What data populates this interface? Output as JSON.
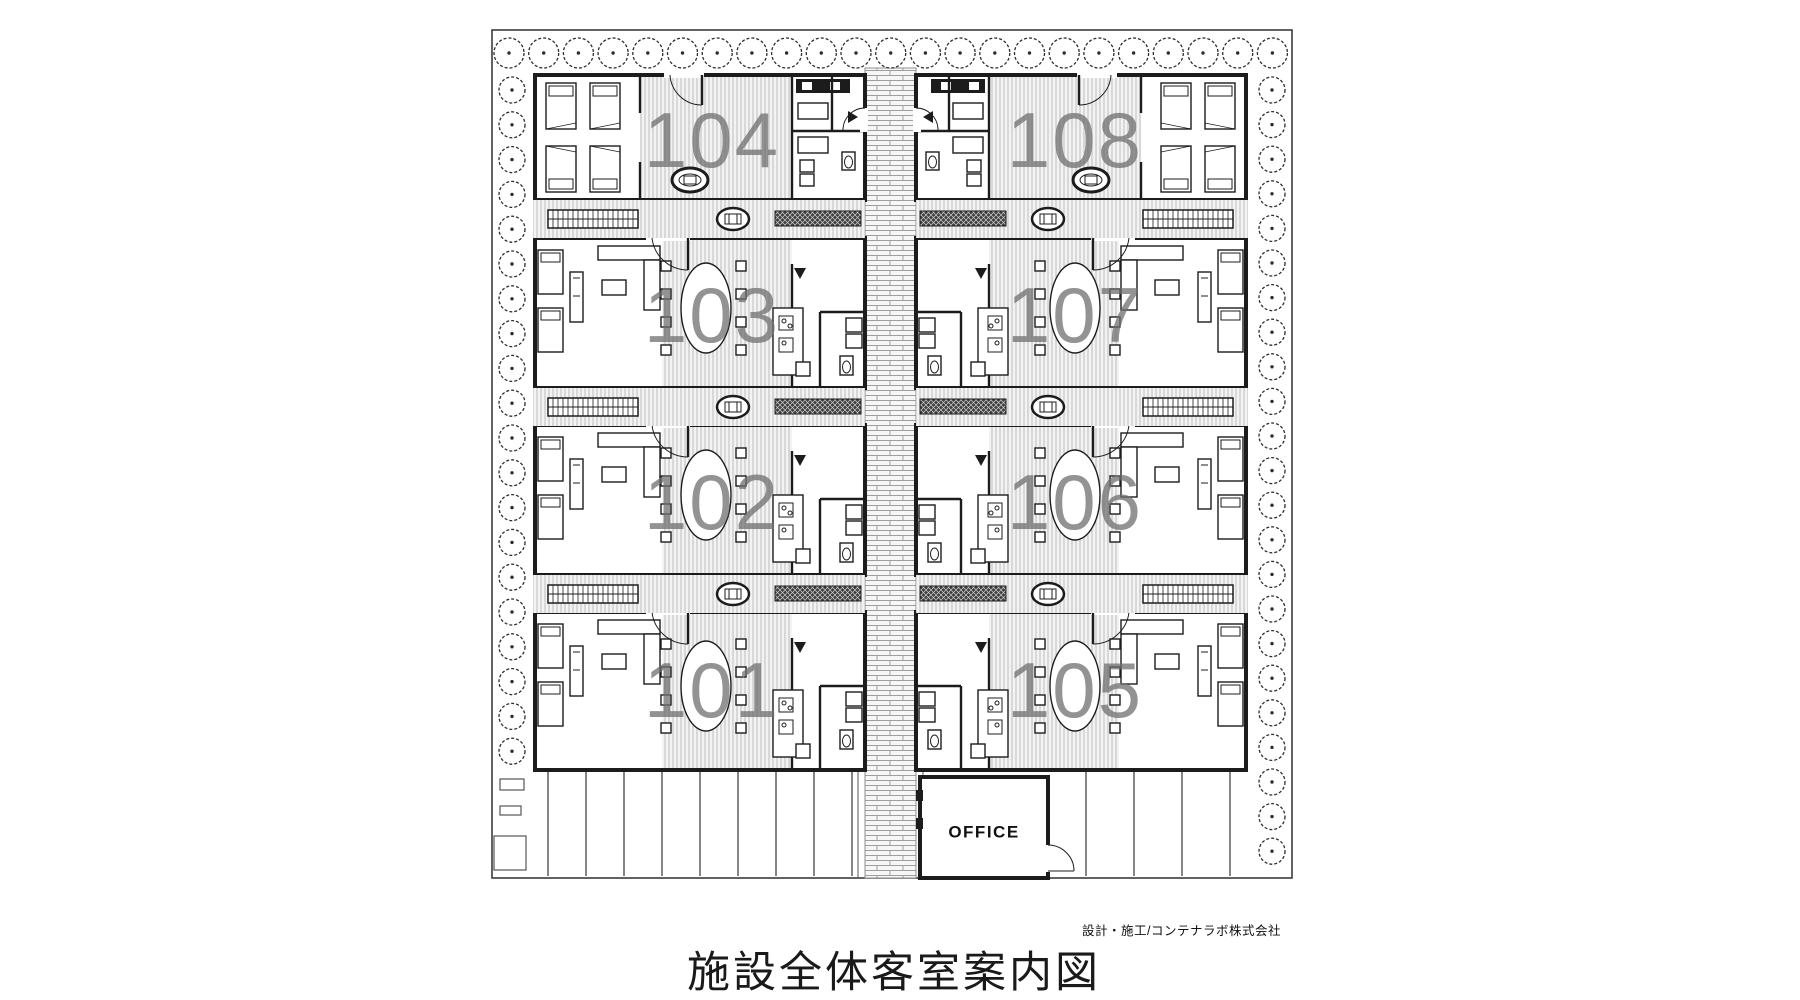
{
  "plan": {
    "caption": "施設全体客室案内図",
    "credit": "設計・施工/コンテナラボ株式会社",
    "office_label": "OFFICE",
    "rooms": [
      {
        "number": "101",
        "side": "left",
        "row": 3
      },
      {
        "number": "102",
        "side": "left",
        "row": 2
      },
      {
        "number": "103",
        "side": "left",
        "row": 1
      },
      {
        "number": "104",
        "side": "left",
        "row": 0
      },
      {
        "number": "105",
        "side": "right",
        "row": 3
      },
      {
        "number": "106",
        "side": "right",
        "row": 2
      },
      {
        "number": "107",
        "side": "right",
        "row": 1
      },
      {
        "number": "108",
        "side": "right",
        "row": 0
      }
    ],
    "colors": {
      "wall": "#1c1c1c",
      "room_label": "#6f6f6f",
      "stripe_floor": "#f3f3f3",
      "stripe_line": "#b8b8b8",
      "deck_dark": "#3f3f3f",
      "brick_line": "#9e9e9e",
      "tree_line": "#2d2d2d",
      "boundary": "#3c3c3c",
      "text": "#111111"
    }
  }
}
